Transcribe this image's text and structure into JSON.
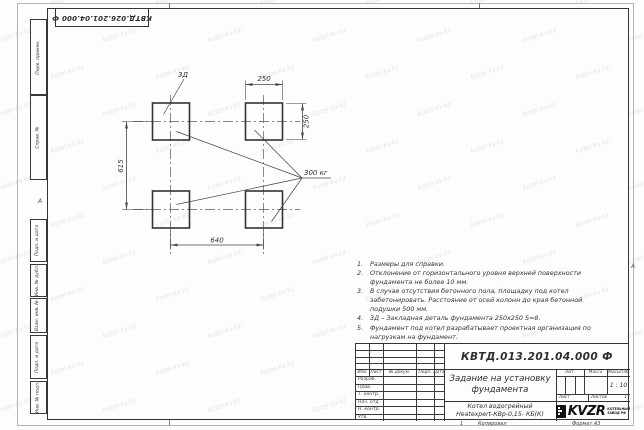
{
  "page": {
    "top_stamp": "КВТД.026.201.04.000 Ф",
    "zone_marker_left": "А",
    "zone_marker_right": "А",
    "fold_mark": "1",
    "copied_label": "Копировал",
    "format_label": "Формат А3"
  },
  "watermark": {
    "text": "kotel-kv.kz"
  },
  "margin": {
    "items": [
      "Перв. примен.",
      "Справ. №",
      "Подп. и дата",
      "Инв. № дубл.",
      "Взам. инв. №",
      "Подп. и дата",
      "Инв. № подл."
    ]
  },
  "drawing": {
    "detail_label": "3Д",
    "load_label": "300 кг",
    "dim_width_top": "250",
    "dim_height_right": "250",
    "dim_span_horizontal": "640",
    "dim_span_vertical": "615"
  },
  "notes": {
    "items": [
      "Размеры для справки.",
      "Отклонение от горизонтального уровня верхней поверхности фундамента не более 10 мм.",
      "В случае отсутствия бетонного пола, площадку под котел забетонировать. Расстояние от осей колонн до края бетонной подушки 500 мм.",
      "3Д – Закладная деталь фундамента 250х250 S=8.",
      "Фундамент под котел разрабатывает проектная организация по нагрузкам на фундамент."
    ]
  },
  "title_block": {
    "designation": "КВТД.013.201.04.000 Ф",
    "title_line1": "Задание на установку",
    "title_line2": "фундамента",
    "product_line1": "Котел водогрейный",
    "product_line2": "Heatexpert-КВр-0,15- КБ(К)",
    "col_izm": "Изм.",
    "col_list": "Лист",
    "col_doc": "№ докум.",
    "col_podp": "Подп.",
    "col_data": "Дата",
    "rows": [
      "Разраб.",
      "Пров.",
      "Т. контр.",
      "Нач. отд.",
      "Н. контр.",
      "Утв."
    ],
    "lit_label": "Лит.",
    "mass_label": "Масса",
    "scale_label": "Масштаб",
    "scale_value": "1 : 10",
    "sheet_label": "Лист",
    "sheets_label": "Листов",
    "sheets_value": "1",
    "logo_text": "KVZR",
    "logo_caption_line1": "КОТЕЛЬНЫЙ",
    "logo_caption_line2": "ЗАВОД РФ"
  }
}
